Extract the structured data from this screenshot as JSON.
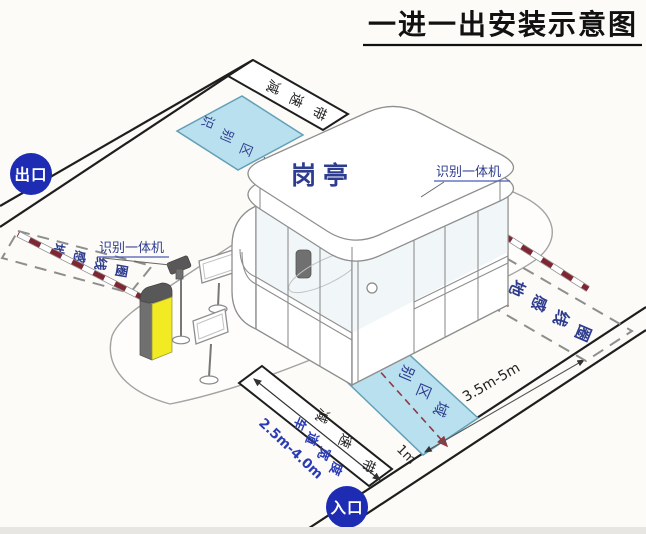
{
  "title": {
    "text": "一进一出安装示意图"
  },
  "badges": {
    "exit": "出口",
    "entrance": "入口"
  },
  "booth": {
    "label": "岗亭"
  },
  "zones": {
    "recognition_top": "识别区域",
    "recognition_bottom": "识别区域",
    "speed_bump_top": "减速带",
    "speed_bump_bottom": "减速带",
    "ground_coil_left": "地感线圈",
    "ground_coil_right": "地感线圈"
  },
  "devices": {
    "reader_left": "识别一体机",
    "reader_right": "识别一体机"
  },
  "measurements": {
    "lane_width_label": "车道宽度",
    "lane_width_value": "2.5m-4.0m",
    "coil_distance": "3.5m-5m",
    "stop_line_offset": "1m"
  },
  "colors": {
    "badge_blue": "#1d2cb3",
    "zone_fill": "#b9e0ee",
    "label_navy": "#2e3c8f",
    "bright_blue": "#2a3cb5",
    "barrier_yellow": "#f2ea22",
    "arm_red": "#7f2633",
    "dash_red": "#8e3a44"
  }
}
